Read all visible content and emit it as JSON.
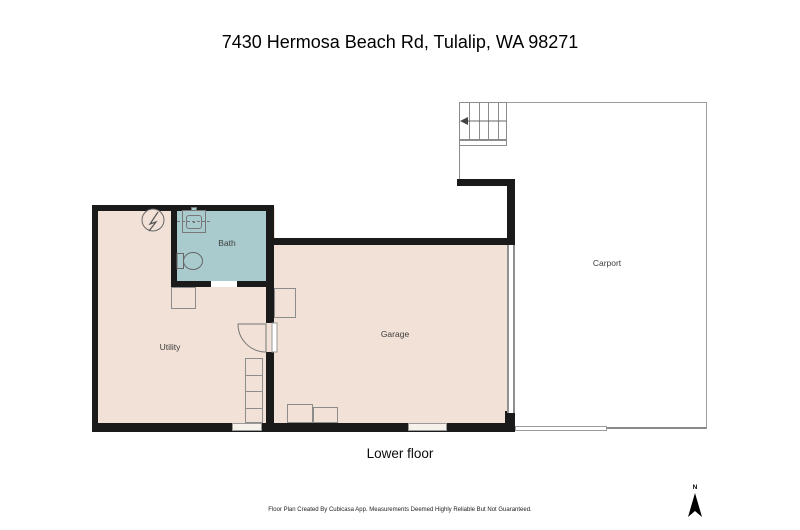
{
  "title": "7430 Hermosa Beach Rd, Tulalip, WA 98271",
  "floor_label": "Lower floor",
  "rooms": {
    "bath": "Bath",
    "utility": "Utility",
    "garage": "Garage",
    "carport": "Carport"
  },
  "compass": {
    "label": "N"
  },
  "footer": "Floor Plan Created By Cubicasa App. Measurements Deemed Highly Reliable But Not Guaranteed.",
  "colors": {
    "floor": "#f2e1d6",
    "bath": "#a9cbce",
    "wall": "#1a1a1a",
    "outline": "#8c8c8c",
    "thin": "#9b9b9b"
  }
}
